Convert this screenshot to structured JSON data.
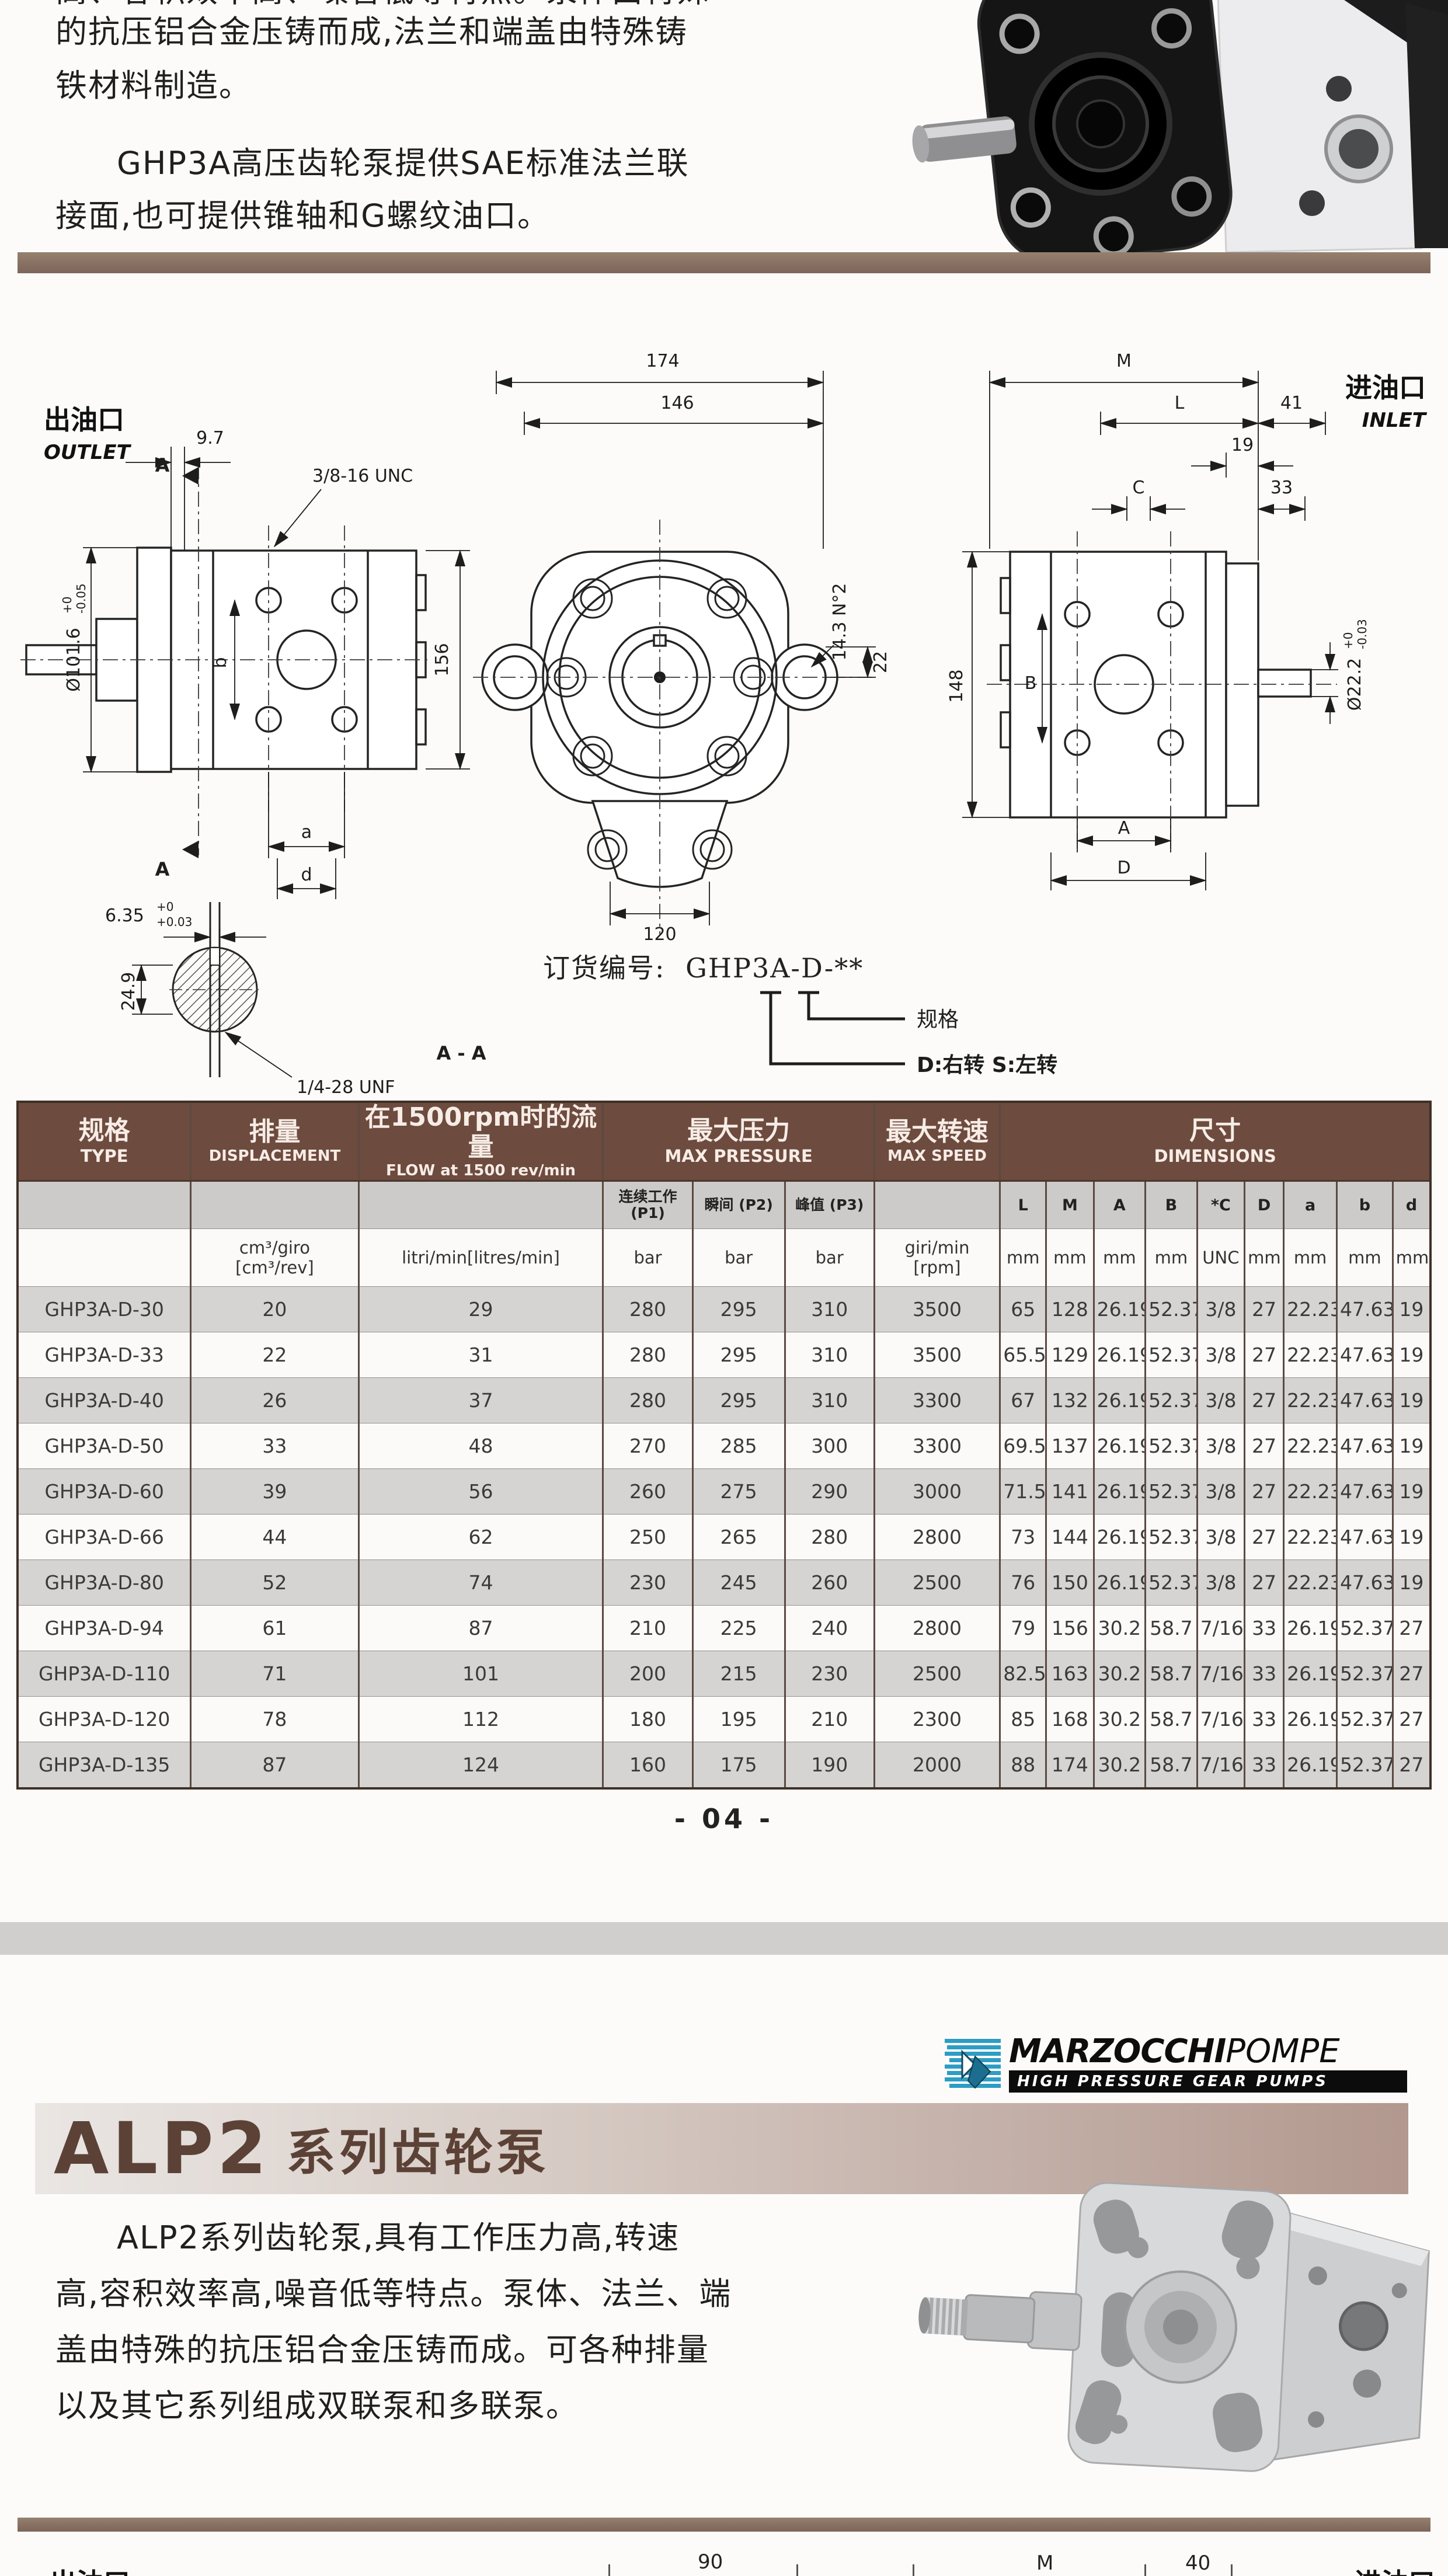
{
  "colors": {
    "header_brown": "#6d4b3e",
    "divider_brown": "#8a7365",
    "row_gray": "#d5d4d2",
    "alp2_text": "#5c4236",
    "logo_blue": "#2d9dc4"
  },
  "page1": {
    "intro_cut_line": "高、容积效率高、噪音低等特点。泵体由特殊",
    "intro_line1": "的抗压铝合金压铸而成,法兰和端盖由特殊铸",
    "intro_line2": "铁材料制造。",
    "para2_line1": "GHP3A高压齿轮泵提供SAE标准法兰联",
    "para2_line2": "接面,也可提供锥轴和G螺纹油口。",
    "outlet_zh": "出油口",
    "outlet_en": "OUTLET",
    "inlet_zh": "进油口",
    "inlet_en": "INLET",
    "drawing": {
      "dim_9_7": "9.7",
      "thread_top": "3/8-16 UNC",
      "dia_left_main": "Ø101.6",
      "dia_left_sup": "+0",
      "dia_left_sub": "-0.05",
      "sec_a_top": "A",
      "sec_a_bottom": "A",
      "dim_b": "b",
      "dim_a": "a",
      "dim_d": "d",
      "dim_156": "156",
      "dim_174": "174",
      "dim_146": "146",
      "dim_120": "120",
      "dim_143": "14.3 N°2",
      "dim_22": "22",
      "dim_M": "M",
      "dim_L": "L",
      "dim_41": "41",
      "dim_19": "19",
      "dim_C": "C",
      "dim_33": "33",
      "dim_148": "148",
      "dim_B": "B",
      "dim_A": "A",
      "dim_D": "D",
      "dia_right_main": "Ø22.2",
      "dia_right_sup": "+0",
      "dia_right_sub": "-0.03",
      "dim_635_main": "6.35",
      "dim_635_sup": "+0",
      "dim_635_sub": "+0.03",
      "dim_249": "24.9",
      "thread_bottom": "1/4-28 UNF",
      "section_aa": "A - A"
    },
    "ordering": {
      "prefix": "订货编号:",
      "code": "GHP3A-D-**",
      "spec_label": "规格",
      "rotation_label": "D:右转  S:左转"
    },
    "table": {
      "head": {
        "type_zh": "规格",
        "type_en": "TYPE",
        "disp_zh": "排量",
        "disp_en": "DISPLACEMENT",
        "flow_zh": "在1500rpm时的流量",
        "flow_en": "FLOW at 1500 rev/min",
        "press_zh": "最大压力",
        "press_en": "MAX PRESSURE",
        "speed_zh": "最大转速",
        "speed_en": "MAX SPEED",
        "dims_zh": "尺寸",
        "dims_en": "DIMENSIONS"
      },
      "sub": {
        "p1": "连续工作 (P1)",
        "p2": "瞬间 (P2)",
        "p3": "峰值 (P3)",
        "dims": [
          "L",
          "M",
          "A",
          "B",
          "*C",
          "D",
          "a",
          "b",
          "d"
        ]
      },
      "units": {
        "disp_a": "cm³/giro",
        "disp_b": "[cm³/rev]",
        "flow": "litri/min[litres/min]",
        "bar1": "bar",
        "bar2": "bar",
        "bar3": "bar",
        "speed_a": "giri/min",
        "speed_b": "[rpm]",
        "dims": [
          "mm",
          "mm",
          "mm",
          "mm",
          "UNC",
          "mm",
          "mm",
          "mm",
          "mm"
        ]
      },
      "rows": [
        [
          "GHP3A-D-30",
          "20",
          "29",
          "280",
          "295",
          "310",
          "3500",
          "65",
          "128",
          "26.19",
          "52.37",
          "3/8",
          "27",
          "22.23",
          "47.63",
          "19"
        ],
        [
          "GHP3A-D-33",
          "22",
          "31",
          "280",
          "295",
          "310",
          "3500",
          "65.5",
          "129",
          "26.19",
          "52.37",
          "3/8",
          "27",
          "22.23",
          "47.63",
          "19"
        ],
        [
          "GHP3A-D-40",
          "26",
          "37",
          "280",
          "295",
          "310",
          "3300",
          "67",
          "132",
          "26.19",
          "52.37",
          "3/8",
          "27",
          "22.23",
          "47.63",
          "19"
        ],
        [
          "GHP3A-D-50",
          "33",
          "48",
          "270",
          "285",
          "300",
          "3300",
          "69.5",
          "137",
          "26.19",
          "52.37",
          "3/8",
          "27",
          "22.23",
          "47.63",
          "19"
        ],
        [
          "GHP3A-D-60",
          "39",
          "56",
          "260",
          "275",
          "290",
          "3000",
          "71.5",
          "141",
          "26.19",
          "52.37",
          "3/8",
          "27",
          "22.23",
          "47.63",
          "19"
        ],
        [
          "GHP3A-D-66",
          "44",
          "62",
          "250",
          "265",
          "280",
          "2800",
          "73",
          "144",
          "26.19",
          "52.37",
          "3/8",
          "27",
          "22.23",
          "47.63",
          "19"
        ],
        [
          "GHP3A-D-80",
          "52",
          "74",
          "230",
          "245",
          "260",
          "2500",
          "76",
          "150",
          "26.19",
          "52.37",
          "3/8",
          "27",
          "22.23",
          "47.63",
          "19"
        ],
        [
          "GHP3A-D-94",
          "61",
          "87",
          "210",
          "225",
          "240",
          "2800",
          "79",
          "156",
          "30.2",
          "58.7",
          "7/16",
          "33",
          "26.19",
          "52.37",
          "27"
        ],
        [
          "GHP3A-D-110",
          "71",
          "101",
          "200",
          "215",
          "230",
          "2500",
          "82.5",
          "163",
          "30.2",
          "58.7",
          "7/16",
          "33",
          "26.19",
          "52.37",
          "27"
        ],
        [
          "GHP3A-D-120",
          "78",
          "112",
          "180",
          "195",
          "210",
          "2300",
          "85",
          "168",
          "30.2",
          "58.7",
          "7/16",
          "33",
          "26.19",
          "52.37",
          "27"
        ],
        [
          "GHP3A-D-135",
          "87",
          "124",
          "160",
          "175",
          "190",
          "2000",
          "88",
          "174",
          "30.2",
          "58.7",
          "7/16",
          "33",
          "26.19",
          "52.37",
          "27"
        ]
      ]
    },
    "page_number": "- 04 -"
  },
  "page2": {
    "logo": {
      "brand_bold": "MARZOCCHI",
      "brand_light": "POMPE",
      "tagline": "HIGH PRESSURE GEAR PUMPS"
    },
    "title_model": "ALP2",
    "title_suffix": "系列齿轮泵",
    "para_line1": "ALP2系列齿轮泵,具有工作压力高,转速",
    "para_line2": "高,容积效率高,噪音低等特点。泵体、法兰、端",
    "para_line3": "盖由特殊的抗压铝合金压铸而成。可各种排量",
    "para_line4": "以及其它系列组成双联泵和多联泵。",
    "bottom": {
      "outlet": "出油口",
      "dim_90": "90",
      "dim_M": "M",
      "dim_40": "40",
      "inlet": "进油口"
    }
  }
}
